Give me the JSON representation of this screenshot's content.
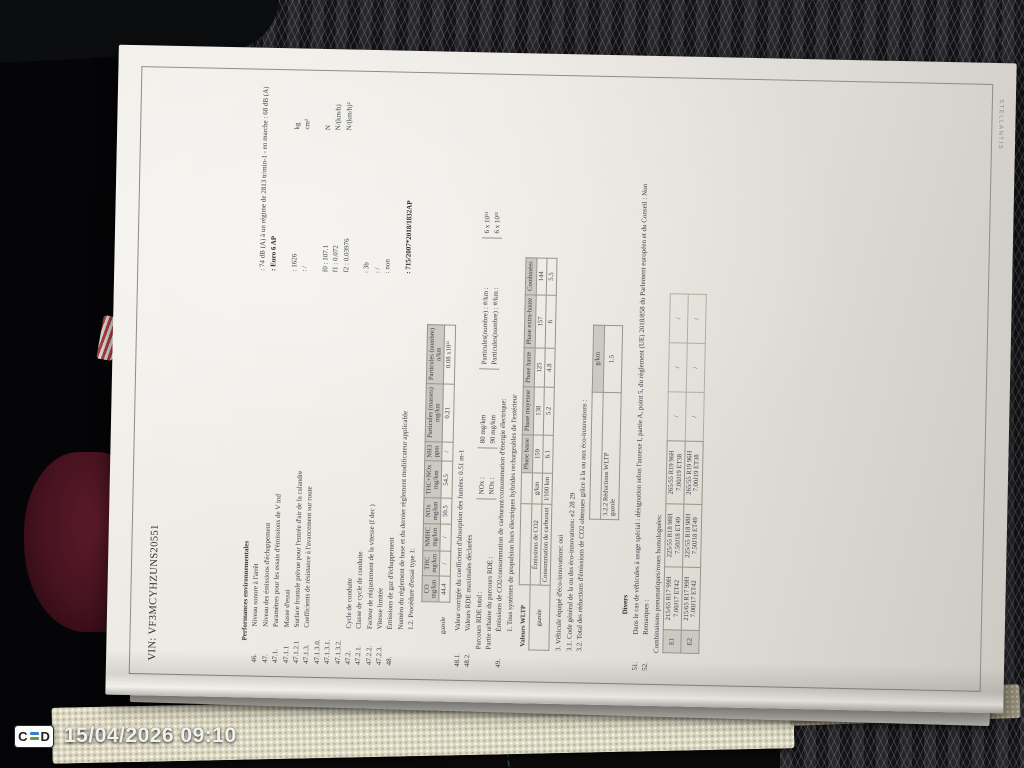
{
  "overlay": {
    "logo_left": "C",
    "logo_right": "D",
    "datetime": "15/04/2026 09:10",
    "logo_bar_colors": [
      "#3c7ccc",
      "#55a336"
    ]
  },
  "paper_edge_text": "STELLANTIS",
  "doc": {
    "vin": "VIN: VF3MCYHZUNS20551",
    "section_title": "Performances environnementales",
    "rows": [
      {
        "num": "46.",
        "label": "Niveau sonore à l'arrêt",
        "value": ": 74 dB (A)   à un régime de 2813 tr/min-1 - en marche :   68 dB (A)",
        "unit": ""
      },
      {
        "num": "47.",
        "label": "Niveau des émissions d'échappement",
        "value": ": Euro 6 AP",
        "unit": ""
      },
      {
        "num": "47.1.",
        "label": "Paramètres pour les essais d'émissions de V ind",
        "value": "",
        "unit": ""
      },
      {
        "num": "47.1.1",
        "label": "Masse d'essai",
        "value": ": 1626",
        "unit": "kg"
      },
      {
        "num": "47.1.2.1",
        "label": "Surface frontale prévue pour l'entrée d'air de la calandre",
        "value": ": /",
        "unit": "cm²"
      },
      {
        "num": "47.1.3.",
        "label": "Coefficients de résistance à l'avancement sur route",
        "value": "",
        "unit": ""
      },
      {
        "num": "47.1.3.0.",
        "label": "",
        "value": "f0 : 107.1",
        "unit": "N"
      },
      {
        "num": "47.1.3.1.",
        "label": "",
        "value": "f1 : 0.072",
        "unit": "N/(km/h)"
      },
      {
        "num": "47.1.3.2.",
        "label": "",
        "value": "f2 : 0.03976",
        "unit": "N/(km/h)²"
      },
      {
        "num": "47.2.",
        "label": "Cycle de conduite",
        "value": "",
        "unit": ""
      },
      {
        "num": "47.2.1.",
        "label": "Classe de cycle de conduite",
        "value": ": 3b",
        "unit": ""
      },
      {
        "num": "47.2.2.",
        "label": "Facteur de réajustement de la vitesse (f dec )",
        "value": ": /",
        "unit": ""
      },
      {
        "num": "47.2.3.",
        "label": "Vitesse limitée",
        "value": ": non",
        "unit": ""
      },
      {
        "num": "48.",
        "label": "Émissions de gaz d'échappement",
        "value": "",
        "unit": ""
      },
      {
        "num": "",
        "label": "Numéro du règlement de base et du dernier règlement modificateur applicable",
        "value": ": 715/2007*2018/1832AP",
        "unit": ""
      },
      {
        "num": "",
        "label": "1.2. Procédure d'essai type 1:",
        "value": "",
        "unit": ""
      }
    ],
    "type1": {
      "row_label": "gazole",
      "columns": [
        {
          "name": "CO",
          "unit": "mg/km"
        },
        {
          "name": "THC",
          "unit": "mg/km"
        },
        {
          "name": "NMHC",
          "unit": "mg/km"
        },
        {
          "name": "NOx",
          "unit": "mg/km"
        },
        {
          "name": "THC+NOx",
          "unit": "mg/km"
        },
        {
          "name": "NH3",
          "unit": "ppm"
        },
        {
          "name": "Particules (masses)",
          "unit": "mg/km"
        },
        {
          "name": "Particules (nombre)",
          "unit": "n/km"
        }
      ],
      "values": [
        "44.4",
        "/",
        "/",
        "50.5",
        "54.5",
        "/",
        "0.21",
        "0.08 x10¹¹"
      ]
    },
    "l481_num": "48.1.",
    "l481": "Valeur corrigée du coefficient d'absorption des fumées: 0.51 m-1",
    "l482_num": "48.2.",
    "l482": "Valeurs RDE maximales déclarées",
    "rde": {
      "row1_label": "Parcours RDE total :",
      "row2_label": "Partie urbaine du parcours RDE :",
      "nox_label": "NOx :",
      "row1_nox": "80 mg/km",
      "row2_nox": "90 mg/km",
      "part_label": "Particules(nombre) : #/km :",
      "row1_part": "6 x 10¹¹",
      "row2_part": "6 x 10¹¹"
    },
    "l49_num": "49.",
    "l49": "Émissions de CO2/consommation de carburant/consommation d'énergie électrique:",
    "l49b": "1. Tous systèmes de propulsion hors électriques hybrides rechargeables de l'extérieur",
    "wltp": {
      "label": "Valeurs WLTP",
      "fuel": "gazole",
      "phases": [
        "Phase basse",
        "Phase moyenne",
        "Phase haute",
        "Phase extra-haute",
        "Combinées"
      ],
      "rows": [
        {
          "name": "Émissions de CO2",
          "unit": "g/km",
          "values": [
            "159",
            "138",
            "125",
            "157",
            "144"
          ]
        },
        {
          "name": "Consommation de carburant",
          "unit": "l/100 km",
          "values": [
            "6.1",
            "5.2",
            "4.8",
            "6",
            "5.5"
          ]
        }
      ]
    },
    "eco": {
      "l3": "3. Véhicule équipé d'éco-innovations: oui",
      "l31": "3.1. Code général de la ou des éco-innovations: e2 28 29",
      "l32": "3.2. Total des réductions d'émissions de CO2 obtenues grâce à la ou aux éco-innovations :",
      "unit": "g/km",
      "label": "3.2.2 Réductions WLTP",
      "fuel": "gazole",
      "value": "1.5"
    },
    "divers_title": "Divers",
    "n51": "51.",
    "t51": "Dans le cas de véhicules à usage spécial : désignation selon l'annexe I, partie A, point 5, du règlement (UE) 2018/858 du Parlement européen et du Conseil : Non",
    "n52": "52.",
    "t52": "Remarques :",
    "tyres": {
      "intro": "Combinaisons pneumatiques/roues homologuées:",
      "rows": [
        {
          "axle": "E1",
          "combos": [
            {
              "tire": "215/65 R17 99H",
              "rim": "7.00J17 ET42"
            },
            {
              "tire": "225/55 R18 98H",
              "rim": "7.50J18 ET49"
            },
            {
              "tire": "265/55 R19 96H",
              "rim": "7.00J19 ET38"
            }
          ],
          "empty": [
            "/",
            "/",
            "/"
          ]
        },
        {
          "axle": "E2",
          "combos": [
            {
              "tire": "215/65 R17 99H",
              "rim": "7.00J17 ET42"
            },
            {
              "tire": "225/55 R18 98H",
              "rim": "7.50J18 ET49"
            },
            {
              "tire": "265/55 R19 96H",
              "rim": "7.00J19 ET38"
            }
          ],
          "empty": [
            "/",
            "/",
            "/"
          ]
        }
      ]
    }
  }
}
